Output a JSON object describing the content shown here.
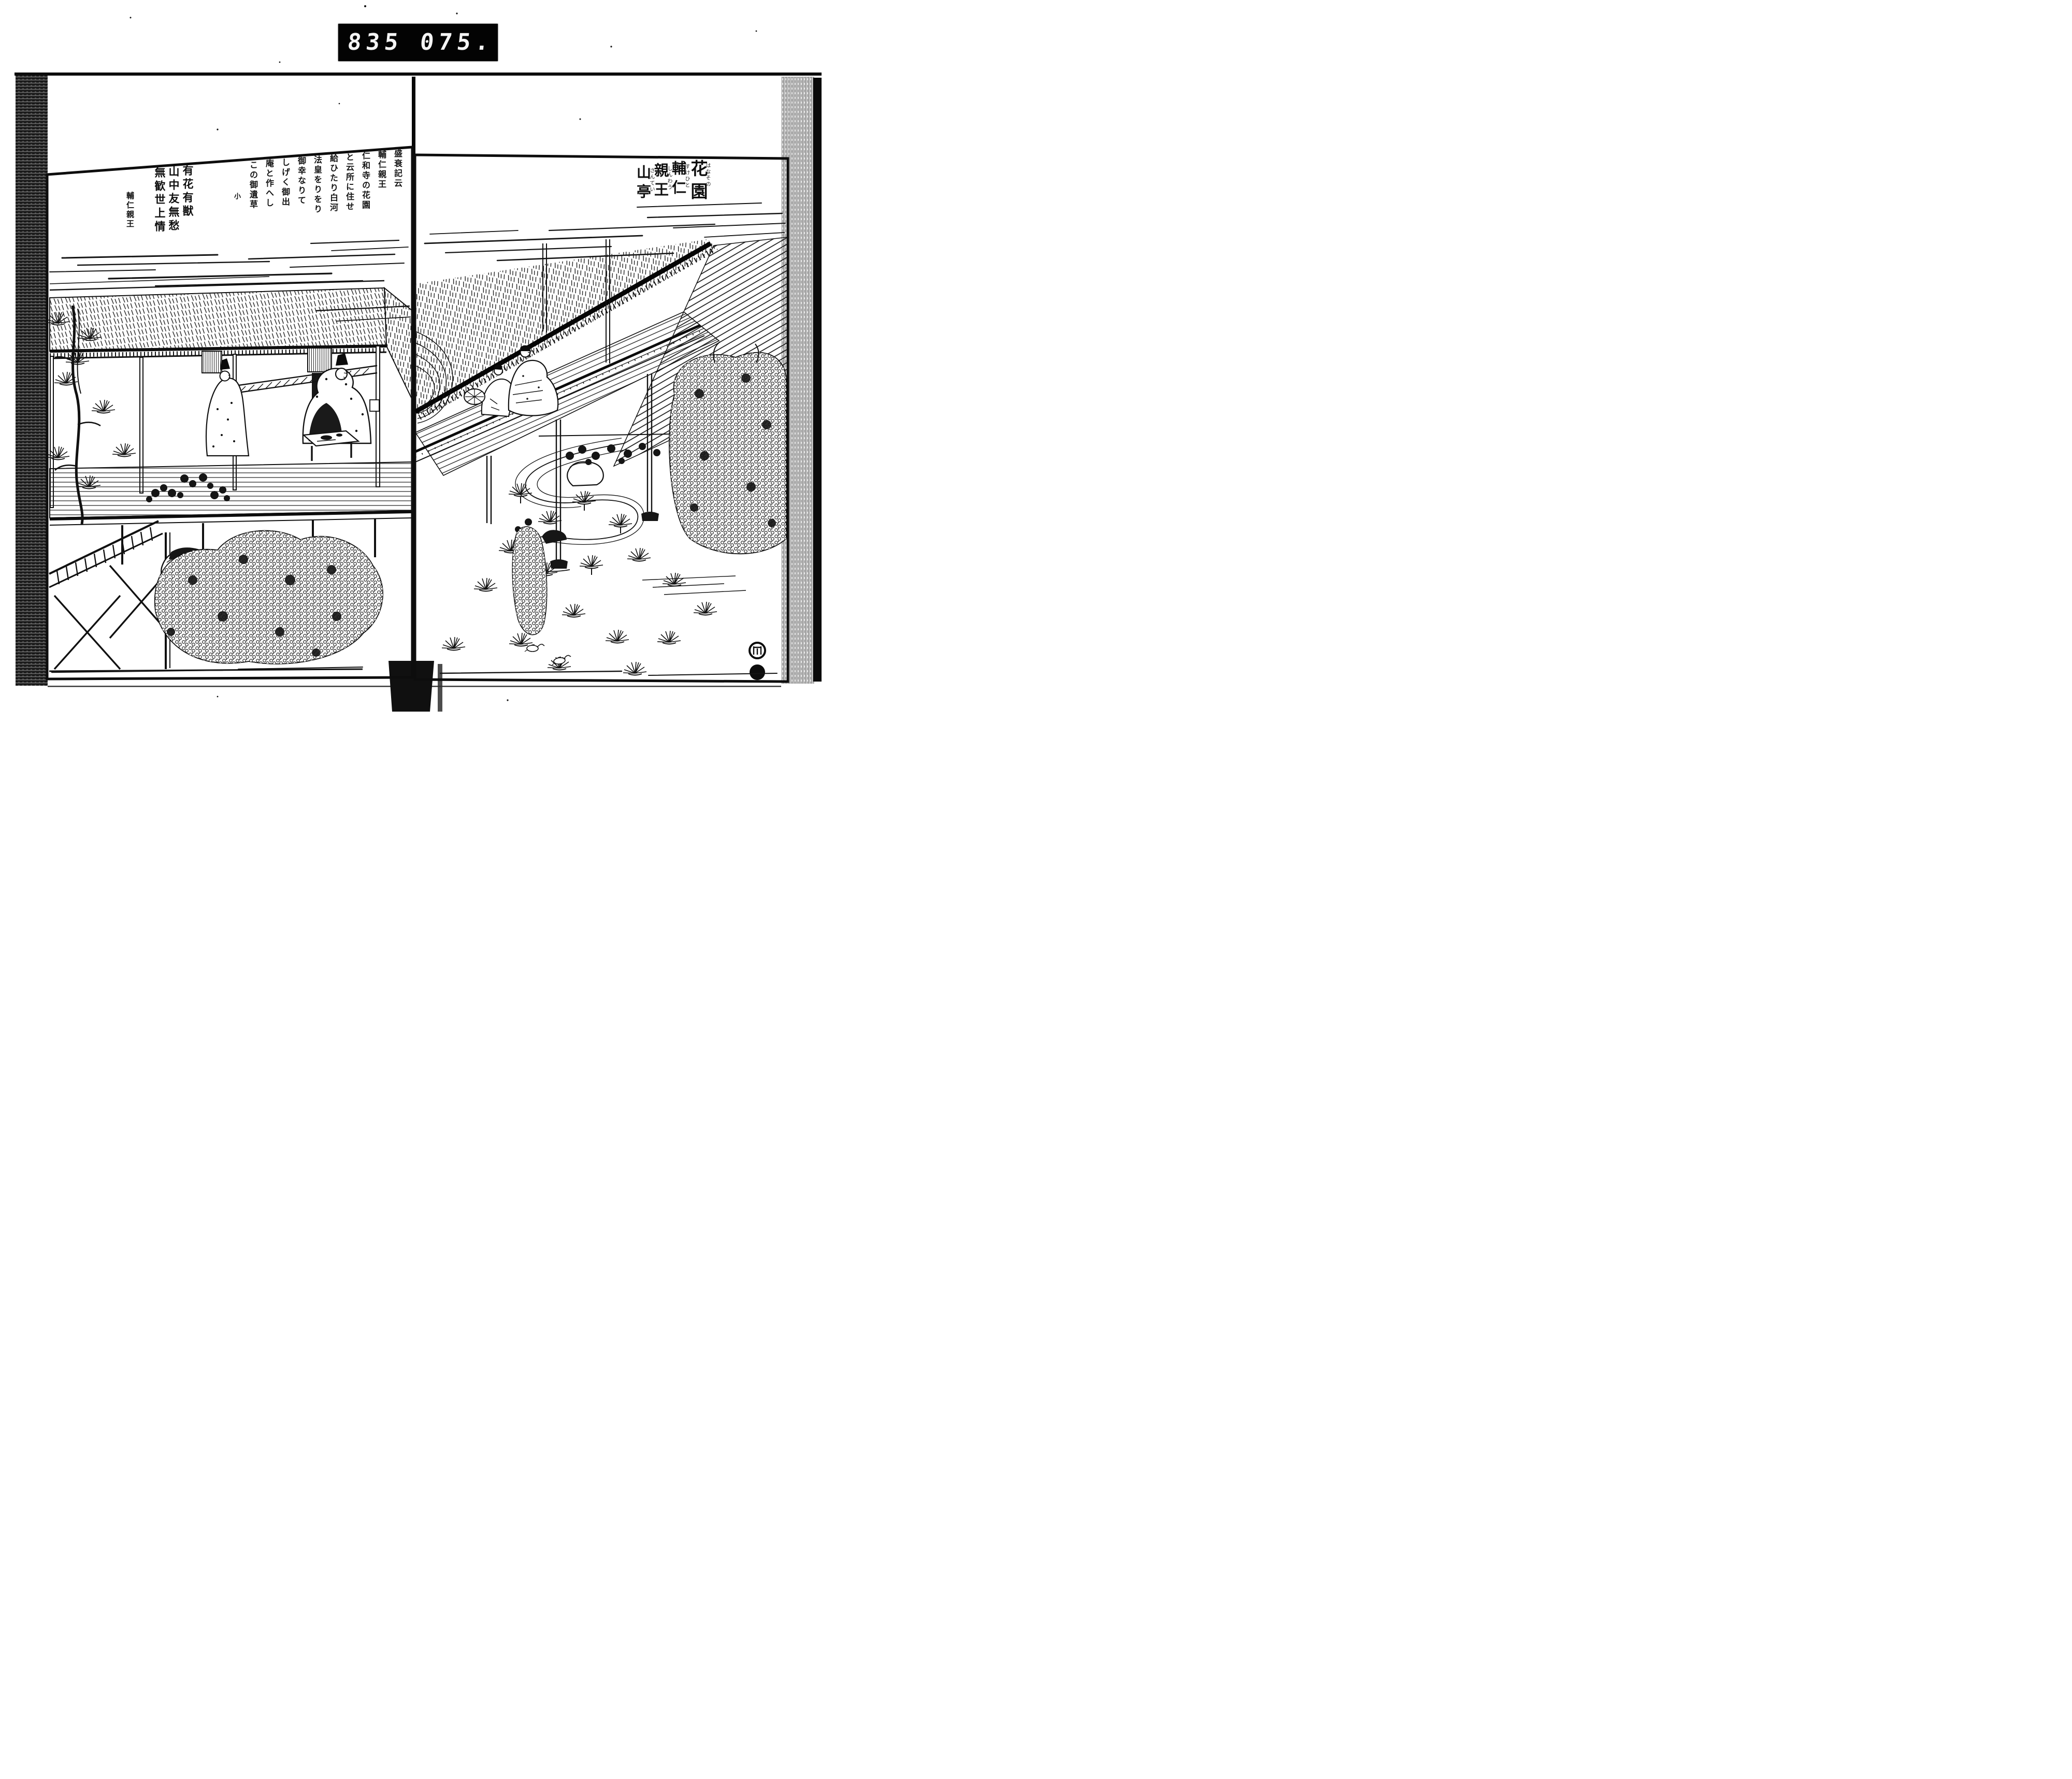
{
  "counter": {
    "left_digits": "835",
    "right_digits": "075.",
    "digit_color": "#f4f4f4",
    "bg_color": "#030303"
  },
  "right_page": {
    "title": [
      {
        "kanji": "花園",
        "kana": "はなその"
      },
      {
        "kanji": "輔仁",
        "kana": "すけひと"
      },
      {
        "kanji": "親王",
        "kana": "しんわう"
      },
      {
        "kanji": "山亭",
        "kana": "さんてい"
      }
    ],
    "seals": {
      "top": "round-seal-open",
      "bottom": "round-seal-solid"
    }
  },
  "left_page": {
    "passage": [
      "盛衰記云",
      "輔仁親王",
      "仁和寺の花園",
      "と云所に住せ",
      "給ひたり白河",
      "法皇をりをり",
      "御幸なりて",
      "しげく御出",
      "庵と作へし",
      "この御遺草"
    ],
    "passage_end_mark": "小",
    "poem": [
      "有花有獣",
      "山中友無愁",
      "無歓世上情"
    ],
    "poem_attribution": "輔仁親王"
  },
  "ink_color": "#111111",
  "paper_color": "#ffffff"
}
